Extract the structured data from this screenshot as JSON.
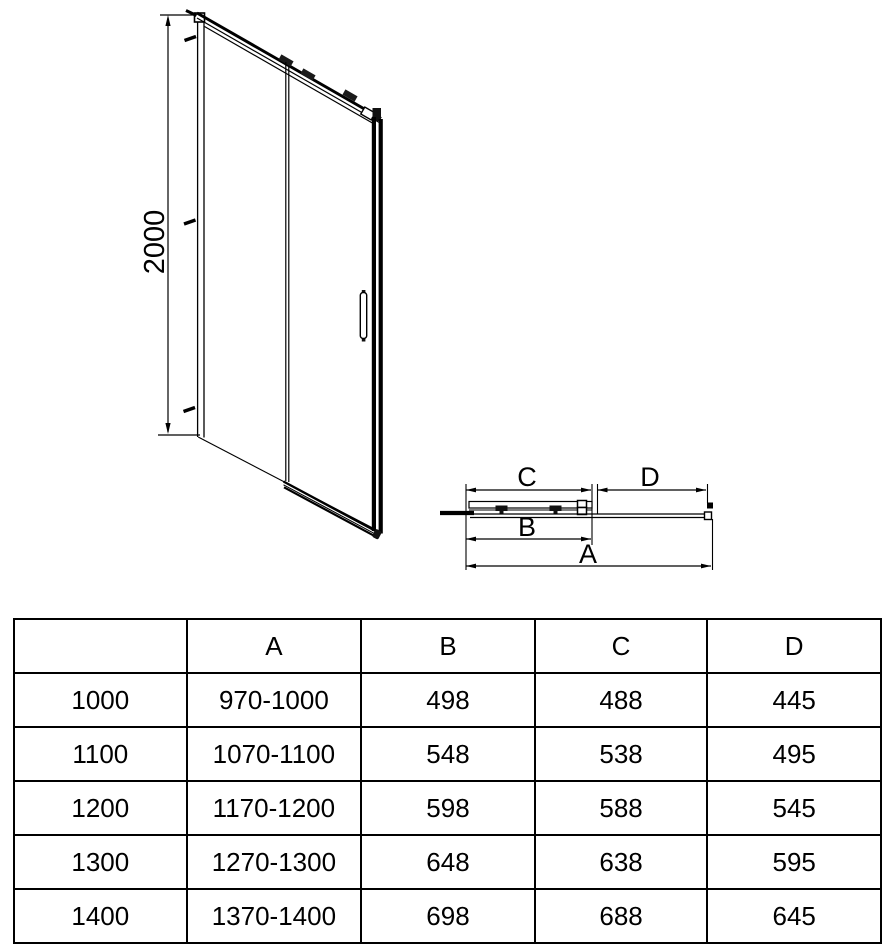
{
  "front_view": {
    "height_dimension": "2000"
  },
  "plan_view": {
    "dim_c_label": "C",
    "dim_d_label": "D",
    "dim_b_label": "B",
    "dim_a_label": "A"
  },
  "size_table": {
    "columns": [
      "",
      "A",
      "B",
      "C",
      "D"
    ],
    "rows": [
      {
        "size": "1000",
        "a": "970-1000",
        "b": "498",
        "c": "488",
        "d": "445"
      },
      {
        "size": "1100",
        "a": "1070-1100",
        "b": "548",
        "c": "538",
        "d": "495"
      },
      {
        "size": "1200",
        "a": "1170-1200",
        "b": "598",
        "c": "588",
        "d": "545"
      },
      {
        "size": "1300",
        "a": "1270-1300",
        "b": "648",
        "c": "638",
        "d": "595"
      },
      {
        "size": "1400",
        "a": "1370-1400",
        "b": "698",
        "c": "688",
        "d": "645"
      }
    ]
  },
  "colors": {
    "line": "#000000",
    "background": "#ffffff"
  }
}
